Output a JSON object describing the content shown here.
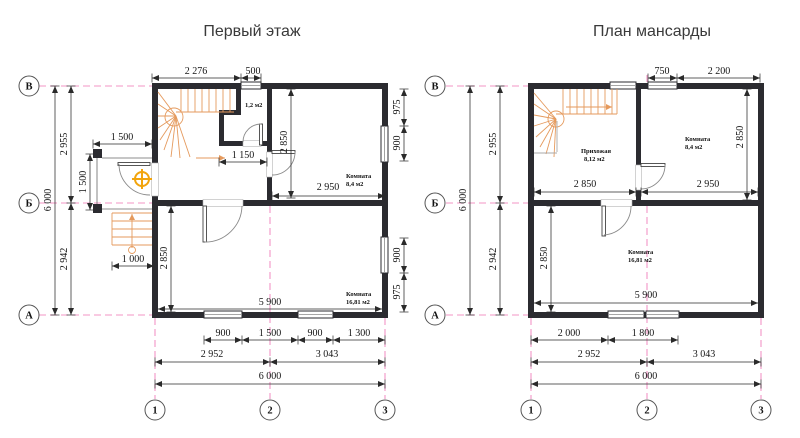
{
  "floor1": {
    "title": "Первый этаж",
    "axes": {
      "row_top": "В",
      "row_mid": "Б",
      "row_bot": "А",
      "col_1": "1",
      "col_2": "2",
      "col_3": "3"
    },
    "left": {
      "total": "6 000",
      "upper": "2 955",
      "lower": "2 942"
    },
    "top": {
      "seg1": "2 276",
      "seg2": "500"
    },
    "porch": {
      "width": "1 500",
      "depth": "1 500",
      "steps": "1 000"
    },
    "wc": {
      "area": "1,2 м2",
      "hall_width": "1 150"
    },
    "room_small": {
      "name": "Комната",
      "area": "8,4 м2",
      "width": "2 950",
      "height": "2 850"
    },
    "right": {
      "top1": "975",
      "top2": "900",
      "bot1": "900",
      "bot2": "975"
    },
    "room_big": {
      "name": "Комната",
      "area": "16,81 м2",
      "width": "5 900",
      "height": "2 850"
    },
    "bottom": {
      "r1": [
        "900",
        "1 500",
        "900",
        "1 300"
      ],
      "r2": [
        "2 952",
        "3 043"
      ],
      "total": "6 000"
    }
  },
  "attic": {
    "title": "План мансарды",
    "axes": {
      "row_top": "В",
      "row_mid": "Б",
      "row_bot": "А",
      "col_1": "1",
      "col_2": "2",
      "col_3": "3"
    },
    "left": {
      "total": "6 000",
      "upper": "2 955",
      "lower": "2 942"
    },
    "top": {
      "seg1": "750",
      "seg2": "2 200"
    },
    "hall": {
      "name": "Прихожая",
      "area": "8,12 м2",
      "width": "2 850"
    },
    "room_small": {
      "name": "Комната",
      "area": "8,4 м2",
      "width": "2 950",
      "height": "2 850"
    },
    "room_big": {
      "name": "Комната",
      "area": "16,81 м2",
      "width": "5 900",
      "height": "2 850"
    },
    "bottom": {
      "r1": [
        "2 000",
        "1 800"
      ],
      "r2": [
        "2 952",
        "3 043"
      ],
      "total": "6 000"
    }
  },
  "colors": {
    "wall": "#2b2b30",
    "axis_pink": "#f395c6",
    "stair_orange": "#e59a5d",
    "lamp": "#f2a40c",
    "dim_text": "#141414"
  }
}
